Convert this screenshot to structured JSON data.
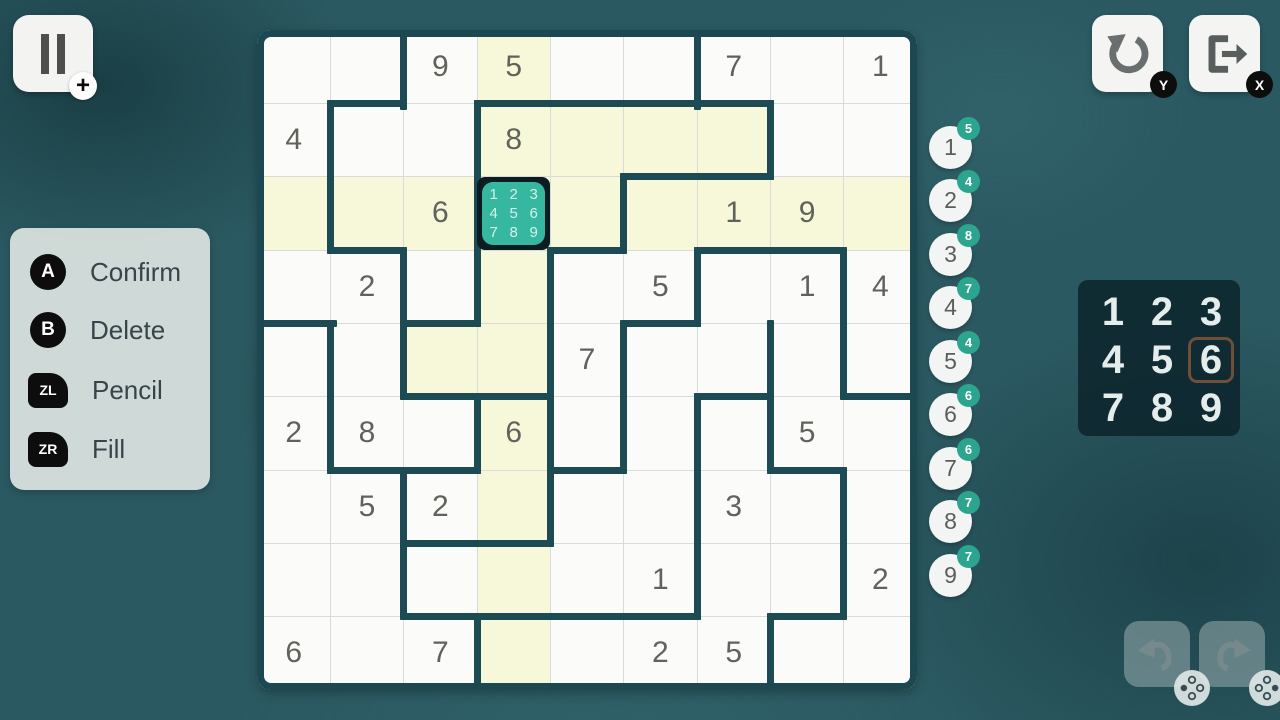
{
  "colors": {
    "background": "#2b5961",
    "wall": "#1d4b53",
    "highlight": "#f6f8d9",
    "selected_fill": "#36b79f",
    "selected_border": "#0b1d21",
    "counter_badge": "#2ba58e",
    "numpad_selected_outline": "#6e5038"
  },
  "pause": {
    "badge": "+"
  },
  "legend": [
    {
      "key": "A",
      "shape": "circle",
      "action": "Confirm"
    },
    {
      "key": "B",
      "shape": "circle",
      "action": "Delete"
    },
    {
      "key": "ZL",
      "shape": "shoulder",
      "action": "Pencil"
    },
    {
      "key": "ZR",
      "shape": "shoulder",
      "action": "Fill"
    }
  ],
  "top_right": {
    "undo_key": "Y",
    "exit_key": "X"
  },
  "board": {
    "size": 9,
    "rows": [
      "..95..7.1",
      "4..8.....",
      "..6...19.",
      ".2...5.14",
      "....7....",
      "28.6...5.",
      ".52...3..",
      ".....1..2",
      "6.7..25.."
    ],
    "selected": {
      "row": 3,
      "col": 4,
      "pencil": [
        "1",
        "2",
        "3",
        "4",
        "5",
        "6",
        "7",
        "8",
        "9"
      ]
    },
    "highlight": {
      "row": 3,
      "col": 4,
      "extra_cells": [
        [
          2,
          5
        ],
        [
          2,
          6
        ],
        [
          2,
          7
        ],
        [
          5,
          3
        ]
      ]
    },
    "walls_v": [
      [
        1,
        2
      ],
      [
        1,
        6
      ],
      [
        2,
        1
      ],
      [
        2,
        3
      ],
      [
        2,
        7
      ],
      [
        3,
        1
      ],
      [
        3,
        3
      ],
      [
        3,
        5
      ],
      [
        4,
        2
      ],
      [
        4,
        3
      ],
      [
        4,
        4
      ],
      [
        4,
        6
      ],
      [
        4,
        8
      ],
      [
        5,
        1
      ],
      [
        5,
        2
      ],
      [
        5,
        4
      ],
      [
        5,
        5
      ],
      [
        5,
        7
      ],
      [
        5,
        8
      ],
      [
        6,
        1
      ],
      [
        6,
        3
      ],
      [
        6,
        4
      ],
      [
        6,
        5
      ],
      [
        6,
        6
      ],
      [
        6,
        7
      ],
      [
        7,
        2
      ],
      [
        7,
        4
      ],
      [
        7,
        6
      ],
      [
        7,
        8
      ],
      [
        8,
        2
      ],
      [
        8,
        6
      ],
      [
        8,
        8
      ],
      [
        9,
        3
      ],
      [
        9,
        7
      ]
    ],
    "walls_h": [
      [
        1,
        2
      ],
      [
        1,
        4
      ],
      [
        1,
        5
      ],
      [
        1,
        6
      ],
      [
        1,
        7
      ],
      [
        2,
        6
      ],
      [
        2,
        7
      ],
      [
        3,
        2
      ],
      [
        3,
        5
      ],
      [
        3,
        7
      ],
      [
        3,
        8
      ],
      [
        4,
        1
      ],
      [
        4,
        3
      ],
      [
        4,
        6
      ],
      [
        5,
        3
      ],
      [
        5,
        4
      ],
      [
        5,
        7
      ],
      [
        5,
        9
      ],
      [
        6,
        2
      ],
      [
        6,
        3
      ],
      [
        6,
        5
      ],
      [
        6,
        8
      ],
      [
        7,
        3
      ],
      [
        7,
        4
      ],
      [
        8,
        3
      ],
      [
        8,
        4
      ],
      [
        8,
        5
      ],
      [
        8,
        6
      ],
      [
        8,
        8
      ]
    ]
  },
  "counters": [
    {
      "digit": "1",
      "remaining": "5"
    },
    {
      "digit": "2",
      "remaining": "4"
    },
    {
      "digit": "3",
      "remaining": "8"
    },
    {
      "digit": "4",
      "remaining": "7"
    },
    {
      "digit": "5",
      "remaining": "4"
    },
    {
      "digit": "6",
      "remaining": "6"
    },
    {
      "digit": "7",
      "remaining": "6"
    },
    {
      "digit": "8",
      "remaining": "7"
    },
    {
      "digit": "9",
      "remaining": "7"
    }
  ],
  "numpad": {
    "keys": [
      "1",
      "2",
      "3",
      "4",
      "5",
      "6",
      "7",
      "8",
      "9"
    ],
    "selected": "6"
  }
}
